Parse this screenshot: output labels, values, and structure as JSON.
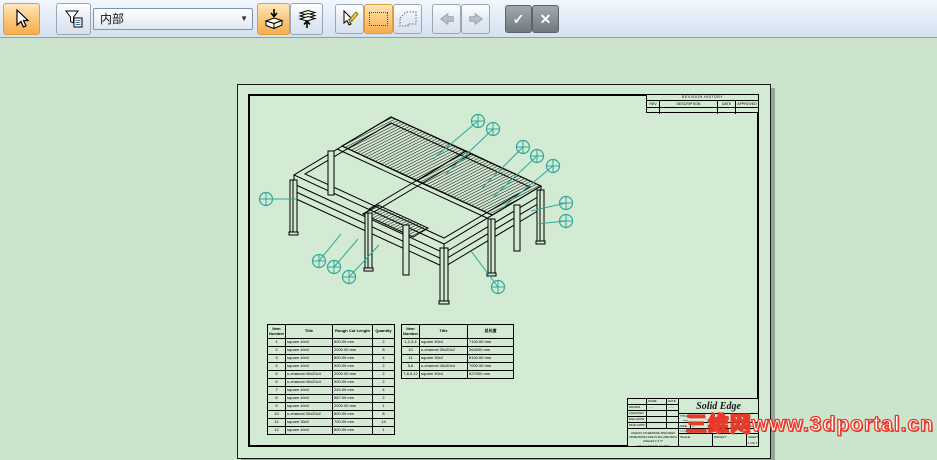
{
  "toolbar": {
    "mode_dropdown": {
      "value": "内部"
    },
    "icons": {
      "select": "cursor-arrow",
      "selection_filter": "funnel-list",
      "activate_part": "box-down-arrow",
      "deactivate_part": "layers-up-arrow",
      "validate_select": "cursor-pencil",
      "box_select": "dotted-rectangle",
      "fence_select": "dotted-polygon",
      "back": "⬅",
      "forward": "➡",
      "accept": "✓",
      "cancel": "✕"
    }
  },
  "sheet": {
    "revision_table": {
      "title": "REVISION HISTORY",
      "columns": [
        "REV",
        "DESCRIPTION",
        "DATE",
        "APPROVED"
      ]
    },
    "bom_cut": {
      "columns": [
        "Item Number",
        "Title",
        "Rough Cut Length",
        "Quantity"
      ],
      "rows": [
        [
          "1",
          "square 40x4",
          "600.00 mm",
          "2"
        ],
        [
          "2",
          "square 40x4",
          "2000.00 mm",
          "8"
        ],
        [
          "3",
          "square 40x4",
          "800.00 mm",
          "4"
        ],
        [
          "4",
          "square 40x4",
          "900.00 mm",
          "2"
        ],
        [
          "5",
          "u-channel 40x20x4",
          "2000.00 mm",
          "2"
        ],
        [
          "6",
          "u-channel 40x20x4",
          "900.00 mm",
          "2"
        ],
        [
          "7",
          "square 40x4",
          "240.00 mm",
          "4"
        ],
        [
          "8",
          "square 40x4",
          "567.00 mm",
          "2"
        ],
        [
          "9",
          "square 40x4",
          "2000.00 mm",
          "1"
        ],
        [
          "10",
          "u-channel 30x20x2",
          "800.00 mm",
          "8"
        ],
        [
          "11",
          "square 30x2",
          "700.00 mm",
          "14"
        ],
        [
          "12",
          "square 40x4",
          "800.00 mm",
          "1"
        ]
      ]
    },
    "bom_total": {
      "columns": [
        "Item Number",
        "Title",
        "总长度"
      ],
      "rows": [
        [
          "1,2,3,4",
          "square 40x4",
          "7100.00 mm"
        ],
        [
          "10",
          "u-channel 30x20x2",
          "264000 mm"
        ],
        [
          "11",
          "square 30x2",
          "8100.00 mm"
        ],
        [
          "5,6",
          "u-channel 40x20x4",
          "7000.00 mm"
        ],
        [
          "7,8,9,12",
          "square 40x4",
          "627000 mm"
        ]
      ]
    },
    "title_block": {
      "logo": "Solid Edge",
      "name_col": "NAME",
      "date_col": "DATE",
      "sig_rows": [
        "DRAWN",
        "CHECKED",
        "ENG APPR",
        "MGR APPR"
      ],
      "drawn_name": "——",
      "drawn_date": "——",
      "note_lines": [
        "UNLESS OTHERWISE SPECIFIED",
        "DIMENSIONS ARE IN MILLIMETERS",
        "ANGLES ± X.X°",
        "2 PL ± X.XX   3 PL ± X.XXX"
      ],
      "title_label": "TITLE",
      "title_value": "—",
      "size_label": "SIZE",
      "dwg_label": "DWG NO",
      "dwg_value": "—",
      "rev_label": "REV",
      "file_label": "FILE NAME:",
      "file_value": "——",
      "scale_label": "SCALE:",
      "weight_label": "WEIGHT:",
      "sheet_label": "SHEET 1 OF 1"
    },
    "balloon_color": "#2fa89c",
    "balloons": [
      {
        "x": 240,
        "y": 36,
        "tx": 195,
        "ty": 74
      },
      {
        "x": 255,
        "y": 44,
        "tx": 208,
        "ty": 89
      },
      {
        "x": 285,
        "y": 62,
        "tx": 243,
        "ty": 104
      },
      {
        "x": 299,
        "y": 71,
        "tx": 253,
        "ty": 114
      },
      {
        "x": 315,
        "y": 81,
        "tx": 263,
        "ty": 124
      },
      {
        "x": 328,
        "y": 118,
        "tx": 293,
        "ty": 126
      },
      {
        "x": 328,
        "y": 136,
        "tx": 298,
        "ty": 139
      },
      {
        "x": 28,
        "y": 114,
        "tx": 58,
        "ty": 114
      },
      {
        "x": 81,
        "y": 176,
        "tx": 103,
        "ty": 149
      },
      {
        "x": 96,
        "y": 182,
        "tx": 120,
        "ty": 154
      },
      {
        "x": 111,
        "y": 192,
        "tx": 141,
        "ty": 160
      },
      {
        "x": 260,
        "y": 202,
        "tx": 233,
        "ty": 166
      }
    ]
  },
  "watermark": "三维网www.3dportal.cn"
}
